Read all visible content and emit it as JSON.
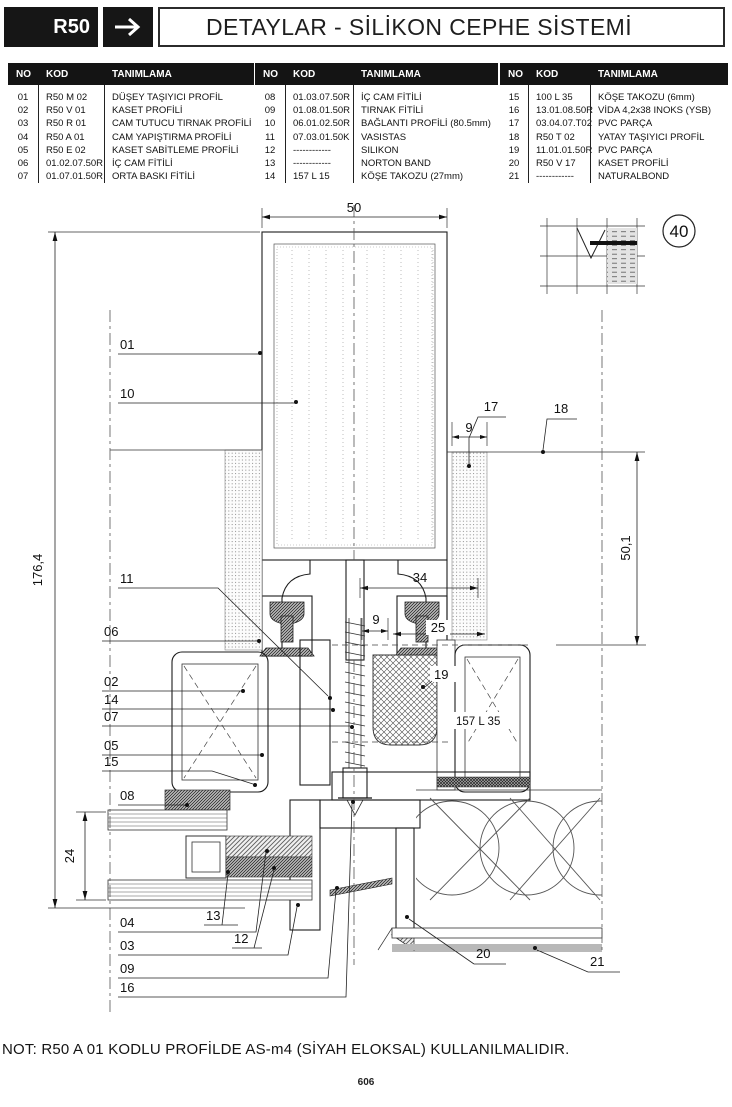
{
  "header": {
    "code": "R50",
    "arrow_icon": "right-arrow",
    "title": "DETAYLAR - SİLİKON CEPHE SİSTEMİ"
  },
  "table": {
    "columns": [
      "NO",
      "KOD",
      "TANIMLAMA"
    ],
    "groups": [
      {
        "rows": [
          {
            "no": "01",
            "kod": "R50 M 02",
            "tanim": "DÜŞEY TAŞIYICI PROFİL"
          },
          {
            "no": "02",
            "kod": "R50 V 01",
            "tanim": "KASET PROFİLİ"
          },
          {
            "no": "03",
            "kod": "R50 R 01",
            "tanim": "CAM TUTUCU TIRNAK PROFİLİ"
          },
          {
            "no": "04",
            "kod": "R50 A 01",
            "tanim": "CAM YAPIŞTIRMA PROFİLİ"
          },
          {
            "no": "05",
            "kod": "R50 E 02",
            "tanim": "KASET SABİTLEME PROFİLİ"
          },
          {
            "no": "06",
            "kod": "01.02.07.50R",
            "tanim": "İÇ CAM FİTİLİ"
          },
          {
            "no": "07",
            "kod": "01.07.01.50R",
            "tanim": "ORTA BASKI FİTİLİ"
          }
        ]
      },
      {
        "rows": [
          {
            "no": "08",
            "kod": "01.03.07.50R",
            "tanim": "İÇ CAM FİTİLİ"
          },
          {
            "no": "09",
            "kod": "01.08.01.50R",
            "tanim": "TIRNAK FİTİLİ"
          },
          {
            "no": "10",
            "kod": "06.01.02.50R",
            "tanim": "BAĞLANTI PROFİLİ (80.5mm)"
          },
          {
            "no": "11",
            "kod": "07.03.01.50K",
            "tanim": "VASISTAS"
          },
          {
            "no": "12",
            "kod": "------------",
            "tanim": "SILIKON"
          },
          {
            "no": "13",
            "kod": "------------",
            "tanim": "NORTON BAND"
          },
          {
            "no": "14",
            "kod": "157 L 15",
            "tanim": "KÖŞE TAKOZU (27mm)"
          }
        ]
      },
      {
        "rows": [
          {
            "no": "15",
            "kod": "100 L 35",
            "tanim": "KÖŞE TAKOZU (6mm)"
          },
          {
            "no": "16",
            "kod": "13.01.08.50R",
            "tanim": "VİDA 4,2x38 INOKS (YSB)"
          },
          {
            "no": "17",
            "kod": "03.04.07.T02",
            "tanim": "PVC PARÇA"
          },
          {
            "no": "18",
            "kod": "R50 T 02",
            "tanim": "YATAY TAŞIYICI PROFİL"
          },
          {
            "no": "19",
            "kod": "11.01.01.50R",
            "tanim": "PVC PARÇA"
          },
          {
            "no": "20",
            "kod": "R50 V 17",
            "tanim": "KASET PROFİLİ"
          },
          {
            "no": "21",
            "kod": "------------",
            "tanim": "NATURALBOND"
          }
        ]
      }
    ]
  },
  "drawing": {
    "detail_number": "40",
    "part_label": "157 L 35",
    "dims": {
      "w50": "50",
      "h1764": "176,4",
      "g24": "24",
      "d17": "17",
      "d9r": "9",
      "d18": "18",
      "d501": "50,1",
      "d34": "34",
      "d9c": "9",
      "d25": "25"
    },
    "callouts": {
      "c01": "01",
      "c10": "10",
      "c11": "11",
      "c06": "06",
      "c02": "02",
      "c14": "14",
      "c07": "07",
      "c05": "05",
      "c15": "15",
      "c08": "08",
      "c13": "13",
      "c04": "04",
      "c03": "03",
      "c12": "12",
      "c09": "09",
      "c16": "16",
      "c19": "19",
      "c20": "20",
      "c21": "21"
    }
  },
  "note": "NOT:  R50 A 01 KODLU PROFİLDE AS-m4 (SİYAH ELOKSAL) KULLANILMALIDIR.",
  "page_number": "606"
}
